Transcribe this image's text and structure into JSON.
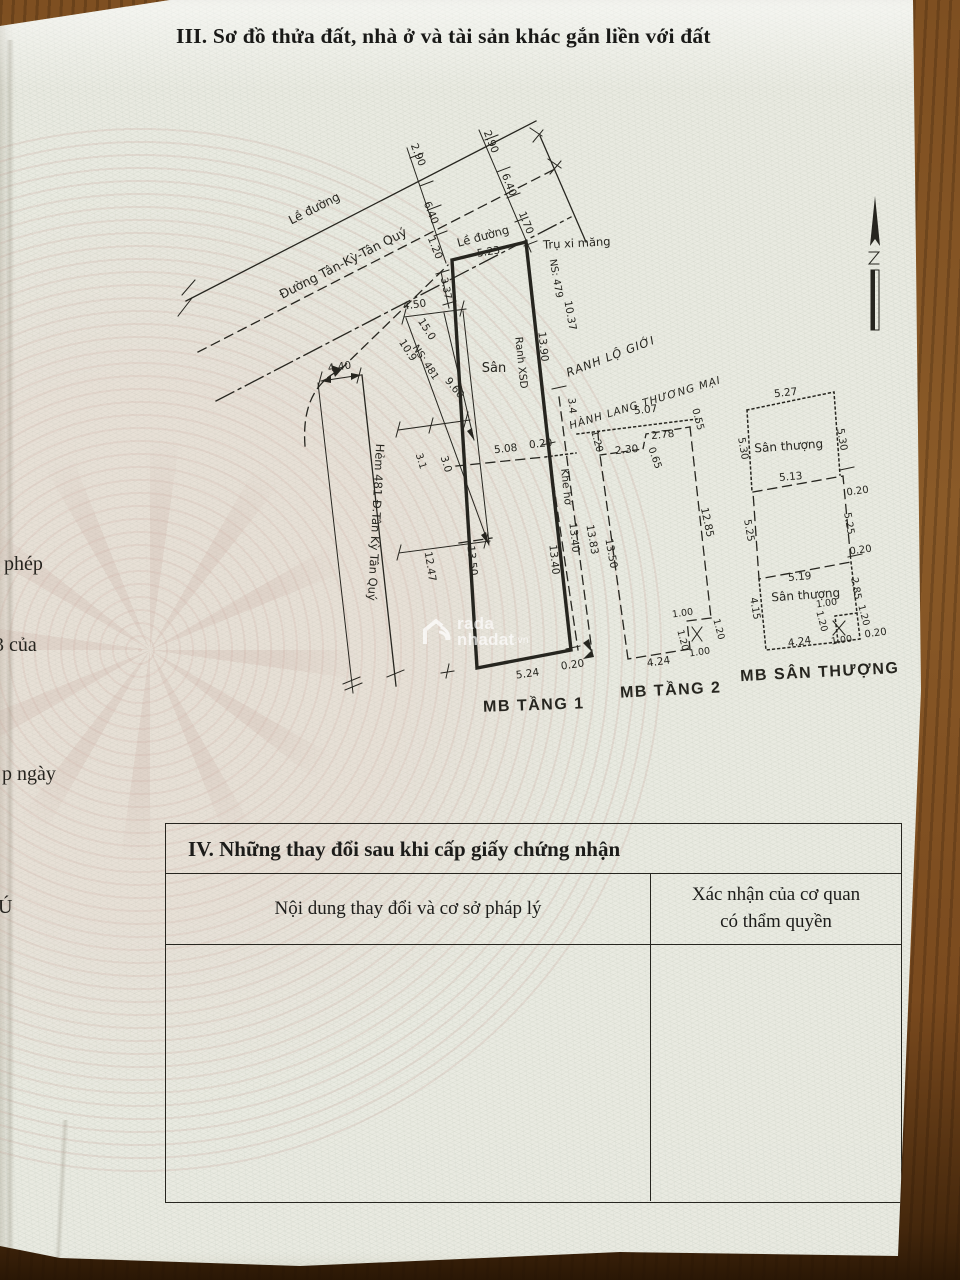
{
  "page": {
    "section_iii_title": "III. Sơ đồ thửa đất, nhà ở và tài sản khác gắn liền với đất",
    "edge_fragments": [
      "phép",
      "3 của",
      "p ngày",
      "Ú"
    ]
  },
  "watermark": {
    "line1": "rada",
    "line2": "nhadat",
    "suffix": ".vn"
  },
  "section_iv": {
    "title": "IV. Những thay đổi sau khi cấp giấy chứng nhận",
    "col_left": "Nội dung thay đổi và cơ sở pháp lý",
    "col_right": "Xác nhận của cơ quan có thẩm quyền"
  },
  "diagram": {
    "labels": [
      {
        "t": "Lề đường",
        "x": 316,
        "y": 212,
        "r": -27,
        "s": 12
      },
      {
        "t": "Đường Tân-Kỳ-Tân Quý",
        "x": 345,
        "y": 267,
        "r": -27,
        "s": 12.5
      },
      {
        "t": "2.90",
        "x": 415,
        "y": 156,
        "r": 68
      },
      {
        "t": "6.40",
        "x": 428,
        "y": 214,
        "r": 68
      },
      {
        "t": "1.20",
        "x": 432,
        "y": 249,
        "r": 68
      },
      {
        "t": "2.90",
        "x": 488,
        "y": 143,
        "r": 68
      },
      {
        "t": "6.40",
        "x": 506,
        "y": 186,
        "r": 68
      },
      {
        "t": "1.70",
        "x": 523,
        "y": 224,
        "r": 68
      },
      {
        "t": "Lề đường",
        "x": 484,
        "y": 240,
        "r": -15,
        "s": 11.5
      },
      {
        "t": "5.23",
        "x": 489,
        "y": 255,
        "r": -9
      },
      {
        "t": "Trụ xi măng",
        "x": 577,
        "y": 247,
        "r": -3,
        "s": 11.5
      },
      {
        "t": "4.40",
        "x": 340,
        "y": 370,
        "r": -8
      },
      {
        "t": "4.50",
        "x": 415,
        "y": 308,
        "r": -8
      },
      {
        "t": "15.0",
        "x": 424,
        "y": 331,
        "r": 57
      },
      {
        "t": "10.9",
        "x": 405,
        "y": 352,
        "r": 57
      },
      {
        "t": "NS: 481",
        "x": 423,
        "y": 364,
        "r": 57,
        "s": 10
      },
      {
        "t": "9.60",
        "x": 452,
        "y": 390,
        "r": 50
      },
      {
        "t": "3.1",
        "x": 418,
        "y": 462,
        "r": 73,
        "s": 10
      },
      {
        "t": "3.0",
        "x": 443,
        "y": 465,
        "r": 73
      },
      {
        "t": "12.47",
        "x": 427,
        "y": 567,
        "r": 81
      },
      {
        "t": "13.50",
        "x": 469,
        "y": 561,
        "r": 84
      },
      {
        "t": "Hẻm 481 Đ.Tân Kỳ Tân Quý",
        "x": 372,
        "y": 522,
        "r": 93,
        "s": 11.5
      },
      {
        "t": "3.37",
        "x": 443,
        "y": 289,
        "r": 78,
        "s": 10
      },
      {
        "t": "Sân",
        "x": 494,
        "y": 372,
        "r": 0,
        "s": 13
      },
      {
        "t": "Ranh XSD",
        "x": 518,
        "y": 363,
        "r": 84
      },
      {
        "t": "13.90",
        "x": 540,
        "y": 347,
        "r": 84
      },
      {
        "t": "NS: 479",
        "x": 553,
        "y": 279,
        "r": 80,
        "s": 10
      },
      {
        "t": "10.37",
        "x": 567,
        "y": 316,
        "r": 80
      },
      {
        "t": "RANH LỘ GIỚI",
        "x": 612,
        "y": 360,
        "r": -21,
        "s": 11.5,
        "c": "hand"
      },
      {
        "t": "3.4",
        "x": 569,
        "y": 406,
        "r": 85,
        "s": 10
      },
      {
        "t": "HÀNH LANG THƯƠNG MẠI",
        "x": 646,
        "y": 406,
        "r": -17,
        "s": 10.5,
        "c": "hand"
      },
      {
        "t": "5.08",
        "x": 506,
        "y": 452,
        "r": -6
      },
      {
        "t": "0.20",
        "x": 541,
        "y": 447,
        "r": -6
      },
      {
        "t": "Khe hở",
        "x": 563,
        "y": 487,
        "r": 84
      },
      {
        "t": "13.40",
        "x": 551,
        "y": 560,
        "r": 84
      },
      {
        "t": "13.40",
        "x": 571,
        "y": 538,
        "r": 84
      },
      {
        "t": "13.83",
        "x": 589,
        "y": 540,
        "r": 80
      },
      {
        "t": "5.24",
        "x": 528,
        "y": 677,
        "r": -8
      },
      {
        "t": "0.20",
        "x": 573,
        "y": 668,
        "r": -8
      },
      {
        "t": "5.07",
        "x": 646,
        "y": 413,
        "r": -6
      },
      {
        "t": "0.55",
        "x": 695,
        "y": 420,
        "r": 75,
        "s": 10
      },
      {
        "t": "1.20",
        "x": 594,
        "y": 442,
        "r": 75,
        "s": 10
      },
      {
        "t": "2.78",
        "x": 663,
        "y": 438,
        "r": -6
      },
      {
        "t": "2.30",
        "x": 627,
        "y": 453,
        "r": -6
      },
      {
        "t": "0.65",
        "x": 652,
        "y": 459,
        "r": 70,
        "s": 10
      },
      {
        "t": "13.50",
        "x": 608,
        "y": 554,
        "r": 80
      },
      {
        "t": "12.85",
        "x": 704,
        "y": 523,
        "r": 78
      },
      {
        "t": "1.00",
        "x": 683,
        "y": 616,
        "r": -8,
        "s": 9.5
      },
      {
        "t": "1.20",
        "x": 716,
        "y": 630,
        "r": 75,
        "s": 9.5
      },
      {
        "t": "1.20",
        "x": 680,
        "y": 641,
        "r": 75,
        "s": 9.5
      },
      {
        "t": "1.00",
        "x": 700,
        "y": 655,
        "r": -8,
        "s": 9.5
      },
      {
        "t": "4.24",
        "x": 659,
        "y": 665,
        "r": -8
      },
      {
        "t": "5.27",
        "x": 786,
        "y": 396,
        "r": -6
      },
      {
        "t": "5.30",
        "x": 740,
        "y": 449,
        "r": 80,
        "s": 10
      },
      {
        "t": "5.30",
        "x": 839,
        "y": 440,
        "r": 80,
        "s": 10
      },
      {
        "t": "Sân thượng",
        "x": 789,
        "y": 450,
        "r": -4,
        "s": 12
      },
      {
        "t": "5.13",
        "x": 791,
        "y": 480,
        "r": -5
      },
      {
        "t": "0.20",
        "x": 858,
        "y": 494,
        "r": -8,
        "s": 10
      },
      {
        "t": "5.25",
        "x": 746,
        "y": 531,
        "r": 80,
        "s": 10
      },
      {
        "t": "5.25",
        "x": 846,
        "y": 524,
        "r": 80,
        "s": 10
      },
      {
        "t": "0.20",
        "x": 861,
        "y": 553,
        "r": -8,
        "s": 10
      },
      {
        "t": "5.19",
        "x": 800,
        "y": 580,
        "r": -5
      },
      {
        "t": "Sân thượng",
        "x": 806,
        "y": 599,
        "r": -4,
        "s": 12
      },
      {
        "t": "4.15",
        "x": 752,
        "y": 609,
        "r": 80,
        "s": 10
      },
      {
        "t": "2.85",
        "x": 853,
        "y": 589,
        "r": 80,
        "s": 10
      },
      {
        "t": "1.00",
        "x": 827,
        "y": 606,
        "r": -8,
        "s": 9.5
      },
      {
        "t": "1.20",
        "x": 861,
        "y": 616,
        "r": 75,
        "s": 9.5
      },
      {
        "t": "1.20",
        "x": 819,
        "y": 622,
        "r": 75,
        "s": 9.5
      },
      {
        "t": "1.00",
        "x": 842,
        "y": 643,
        "r": -8,
        "s": 9.5
      },
      {
        "t": "4.24",
        "x": 800,
        "y": 645,
        "r": -8
      },
      {
        "t": "0.20",
        "x": 876,
        "y": 636,
        "r": -8,
        "s": 10
      },
      {
        "t": "MB TẦNG 1",
        "x": 534,
        "y": 710,
        "r": -2,
        "s": 16,
        "c": "plan"
      },
      {
        "t": "MB TẦNG 2",
        "x": 671,
        "y": 695,
        "r": -3,
        "s": 16,
        "c": "plan"
      },
      {
        "t": "MB SÂN THƯỢNG",
        "x": 820,
        "y": 677,
        "r": -3,
        "s": 16,
        "c": "plan"
      }
    ]
  }
}
